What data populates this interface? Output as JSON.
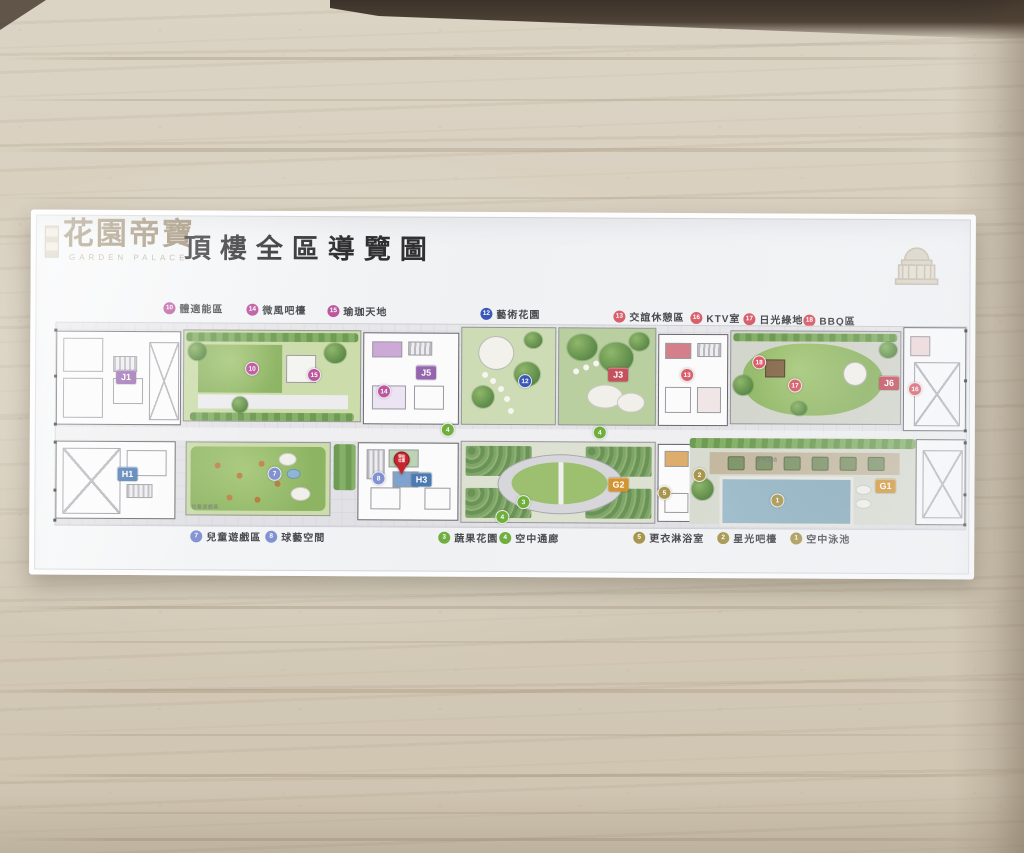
{
  "sign": {
    "logo": {
      "name": "花園帝寶",
      "subtitle": "GARDEN PALACE"
    },
    "title": "頂樓全區導覽圖",
    "legend_top": [
      {
        "num": "10",
        "label": "體適能區"
      },
      {
        "num": "14",
        "label": "微風吧檯"
      },
      {
        "num": "15",
        "label": "瑜珈天地"
      },
      {
        "num": "12",
        "label": "藝術花園"
      },
      {
        "num": "13",
        "label": "交誼休憩區"
      },
      {
        "num": "16",
        "label": "KTV室"
      },
      {
        "num": "17",
        "label": "日光綠地"
      },
      {
        "num": "18",
        "label": "BBQ區"
      }
    ],
    "legend_bottom": [
      {
        "num": "7",
        "label": "兒童遊戲區"
      },
      {
        "num": "8",
        "label": "球藝空間"
      },
      {
        "num": "3",
        "label": "蔬果花園"
      },
      {
        "num": "4",
        "label": "空中通廊"
      },
      {
        "num": "5",
        "label": "更衣淋浴室"
      },
      {
        "num": "2",
        "label": "星光吧檯"
      },
      {
        "num": "1",
        "label": "空中泳池"
      }
    ],
    "map": {
      "badges": [
        "J1",
        "J5",
        "J3",
        "J6",
        "H1",
        "H3",
        "G2",
        "G1"
      ],
      "markers": [
        {
          "num": "10"
        },
        {
          "num": "15"
        },
        {
          "num": "14"
        },
        {
          "num": "12"
        },
        {
          "num": "13"
        },
        {
          "num": "16"
        },
        {
          "num": "17"
        },
        {
          "num": "18"
        },
        {
          "num": "7"
        },
        {
          "num": "8"
        },
        {
          "num": "3"
        },
        {
          "num": "4"
        },
        {
          "num": "4"
        },
        {
          "num": "4"
        },
        {
          "num": "5"
        },
        {
          "num": "2"
        },
        {
          "num": "1"
        }
      ],
      "area_labels": [
        "兒童遊戲區",
        "空中泳池"
      ],
      "pin_label": "現在位置"
    }
  }
}
